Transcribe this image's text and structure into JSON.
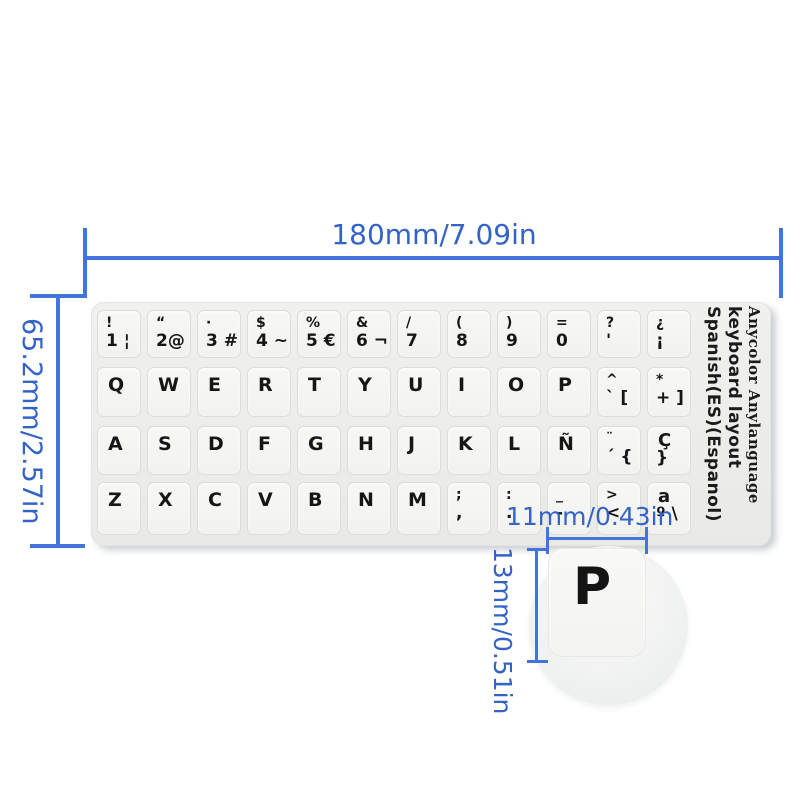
{
  "dimensions": {
    "sticker_width_label": "180mm/7.09in",
    "sticker_height_label": "65.2mm/2.57in",
    "key_width_label": "11mm/0.43in",
    "key_height_label": "13mm/0.51in"
  },
  "colors": {
    "dimension_blue_text": "#3463c6",
    "dimension_blue_line": "#4274da",
    "sticker_background": "#ececea",
    "key_background": "#f5f5f3",
    "key_text": "#161616"
  },
  "magnifier": {
    "key_label": "P"
  },
  "keyboard": {
    "side_text_line1": "Spanish(ES)(Espanol)",
    "side_text_line2": "keyboard layout",
    "side_text_line3": "Anycolor Anylanguage",
    "rows": [
      {
        "keys": [
          {
            "t": "!",
            "b": "1 ¦"
          },
          {
            "t": "“",
            "b": "2@"
          },
          {
            "t": "·",
            "b": "3 #"
          },
          {
            "t": "$",
            "b": "4 ~"
          },
          {
            "t": "%",
            "b": "5 €"
          },
          {
            "t": "&",
            "b": "6 ¬"
          },
          {
            "t": "/",
            "b": "7"
          },
          {
            "t": "(",
            "b": "8"
          },
          {
            "t": ")",
            "b": "9"
          },
          {
            "t": "=",
            "b": "0"
          },
          {
            "t": "?",
            "b": "'"
          },
          {
            "t": "¿",
            "b": "¡"
          }
        ]
      },
      {
        "keys": [
          {
            "t": "Q"
          },
          {
            "t": "W"
          },
          {
            "t": "E"
          },
          {
            "t": "R"
          },
          {
            "t": "T"
          },
          {
            "t": "Y"
          },
          {
            "t": "U"
          },
          {
            "t": "I"
          },
          {
            "t": "O"
          },
          {
            "t": "P"
          },
          {
            "t": "^",
            "b": "` ["
          },
          {
            "t": "*",
            "b": "+ ]"
          }
        ]
      },
      {
        "keys": [
          {
            "t": "A"
          },
          {
            "t": "S"
          },
          {
            "t": "D"
          },
          {
            "t": "F"
          },
          {
            "t": "G"
          },
          {
            "t": "H"
          },
          {
            "t": "J"
          },
          {
            "t": "K"
          },
          {
            "t": "L"
          },
          {
            "t": "Ñ"
          },
          {
            "t": "¨",
            "b": "´ {"
          },
          {
            "t": "Ç",
            "b": "}",
            "big": true
          }
        ]
      },
      {
        "keys": [
          {
            "t": "Z"
          },
          {
            "t": "X"
          },
          {
            "t": "C"
          },
          {
            "t": "V"
          },
          {
            "t": "B"
          },
          {
            "t": "N"
          },
          {
            "t": "M"
          },
          {
            "t": ";",
            "b": ","
          },
          {
            "t": ":",
            "b": "."
          },
          {
            "t": "_",
            "b": "-"
          },
          {
            "t": ">",
            "b": "<"
          },
          {
            "t": "a",
            "b": "º \\",
            "big": true
          }
        ]
      }
    ]
  }
}
